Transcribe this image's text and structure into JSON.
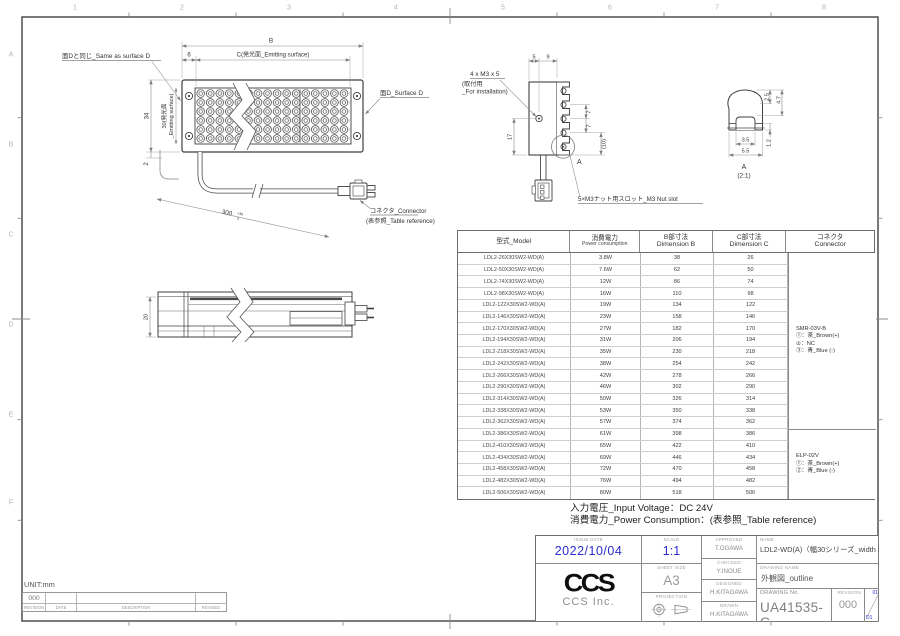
{
  "sheet": {
    "cols": [
      "1",
      "2",
      "3",
      "4",
      "5",
      "6",
      "7",
      "8"
    ],
    "rows": [
      "A",
      "B",
      "C",
      "D",
      "E",
      "F"
    ]
  },
  "front_view": {
    "same_d": "面Dと同じ_Same as surface D",
    "dim_b": "B",
    "dim_6": "6",
    "dim_c": "C(発光面_Emitting surface)",
    "dim_34": "34",
    "em30a": "30(発光面",
    "em30b": "_Emitting surface)",
    "dim_2": "2",
    "dim_300": "300",
    "tol_hi": "+30",
    "tol_lo": "0",
    "surface_d": "面D_Surface D",
    "conn1": "コネクタ_Connector",
    "conn2": "(表参照_Table reference)"
  },
  "end_view": {
    "dim_5": "5",
    "dim_9": "9",
    "dim_17": "17",
    "dim_7a": "7",
    "dim_7b": "7",
    "dim_10": "(10)",
    "m3a": "4 x M3 x 5",
    "m3b": "(取付用",
    "m3c": "_For installation)",
    "a_mark": "A",
    "slot": "5×M3ナット用スロット_M3 Nut slot"
  },
  "detail_a": {
    "dim_25": "2.5",
    "dim_47": "4.7",
    "dim_35": "3.5",
    "dim_55": "5.5",
    "dim_12": "1.2",
    "label": "A",
    "scale": "(2:1)"
  },
  "side_view": {
    "dim_20": "20"
  },
  "table": {
    "headers": {
      "model": "型式_Model",
      "power_jp": "消費電力",
      "power_en": "Power consumption",
      "b_jp": "B部寸法",
      "b_en": "Dimension B",
      "c_jp": "C部寸法",
      "c_en": "Dimension C",
      "conn_jp": "コネクタ",
      "conn_en": "Connector"
    },
    "rows": [
      {
        "model": "LDL2-26X30SW2-WD(A)",
        "power": "3.8W",
        "b": "38",
        "c": "26"
      },
      {
        "model": "LDL2-50X30SW2-WD(A)",
        "power": "7.6W",
        "b": "62",
        "c": "50"
      },
      {
        "model": "LDL2-74X30SW2-WD(A)",
        "power": "12W",
        "b": "86",
        "c": "74"
      },
      {
        "model": "LDL2-98X30SW2-WD(A)",
        "power": "16W",
        "b": "110",
        "c": "98"
      },
      {
        "model": "LDL2-122X30SW2-WD(A)",
        "power": "19W",
        "b": "134",
        "c": "122"
      },
      {
        "model": "LDL2-146X30SW2-WD(A)",
        "power": "23W",
        "b": "158",
        "c": "146"
      },
      {
        "model": "LDL2-170X30SW2-WD(A)",
        "power": "27W",
        "b": "182",
        "c": "170"
      },
      {
        "model": "LDL2-194X30SW2-WD(A)",
        "power": "31W",
        "b": "206",
        "c": "194"
      },
      {
        "model": "LDL2-218X30SW2-WD(A)",
        "power": "35W",
        "b": "230",
        "c": "218"
      },
      {
        "model": "LDL2-242X30SW2-WD(A)",
        "power": "38W",
        "b": "254",
        "c": "242"
      },
      {
        "model": "LDL2-266X30SW2-WD(A)",
        "power": "42W",
        "b": "278",
        "c": "266"
      },
      {
        "model": "LDL2-290X30SW2-WD(A)",
        "power": "46W",
        "b": "302",
        "c": "290"
      },
      {
        "model": "LDL2-314X30SW2-WD(A)",
        "power": "50W",
        "b": "326",
        "c": "314"
      },
      {
        "model": "LDL2-338X30SW2-WD(A)",
        "power": "53W",
        "b": "350",
        "c": "338"
      },
      {
        "model": "LDL2-362X30SW2-WD(A)",
        "power": "57W",
        "b": "374",
        "c": "362"
      },
      {
        "model": "LDL2-386X30SW2-WD(A)",
        "power": "61W",
        "b": "398",
        "c": "386"
      },
      {
        "model": "LDL2-410X30SW2-WD(A)",
        "power": "65W",
        "b": "422",
        "c": "410"
      },
      {
        "model": "LDL2-434X30SW2-WD(A)",
        "power": "69W",
        "b": "446",
        "c": "434"
      },
      {
        "model": "LDL2-458X30SW2-WD(A)",
        "power": "72W",
        "b": "470",
        "c": "458"
      },
      {
        "model": "LDL2-482X30SW2-WD(A)",
        "power": "76W",
        "b": "494",
        "c": "482"
      },
      {
        "model": "LDL2-506X30SW2-WD(A)",
        "power": "80W",
        "b": "518",
        "c": "506"
      }
    ],
    "connector_groups": [
      {
        "name": "SMR-03V-B",
        "pin1": "①：茶_Brown(+)",
        "pin2": "②：NC",
        "pin3": "③：青_Blue (-)"
      },
      {
        "name": "ELP-02V",
        "pin1": "①：茶_Brown(+)",
        "pin2": "②：青_Blue (-)",
        "pin3": ""
      }
    ]
  },
  "notes": {
    "voltage": "入力電圧_Input Voltage：DC 24V",
    "power": "消費電力_Power Consumption：(表参照_Table reference)"
  },
  "title_block": {
    "issue_date_label": "ISSUE DATE",
    "issue_date": "2022/10/04",
    "scale_label": "SCALE",
    "scale": "1:1",
    "sheet_size_label": "SHEET  SIZE",
    "sheet_size": "A3",
    "projection_label": "PROJECTION",
    "approved_label": "APPROVED",
    "approved": "T.OGAWA",
    "checked_label": "CHECKED",
    "checked": "Y.INOUE",
    "designed_label": "DESIGNED",
    "designed": "H.KITAGAWA",
    "drawn_label": "DRAWN",
    "drawn": "H.KITAGAWA",
    "name_label": "NAME",
    "name": "LDL2-WD(A)（幅30シリーズ_width 30 series)",
    "drawing_name_label": "DRAWING  NAME",
    "drawing_name": "外観図_outline",
    "drawing_no_label": "DRAWING No.",
    "drawing_no": "UA41535-G",
    "revision_label": "REVISION",
    "revision": "000",
    "zone_top": "01",
    "zone_bottom": "D1",
    "logo": "CCS",
    "company": "CCS Inc."
  },
  "unit_strip": {
    "unit": "UNIT:mm",
    "version": "000",
    "version_label": "REVISION",
    "date_label": "DATE",
    "description_label": "DESCRIPTION",
    "revised_label": "REVISED"
  }
}
